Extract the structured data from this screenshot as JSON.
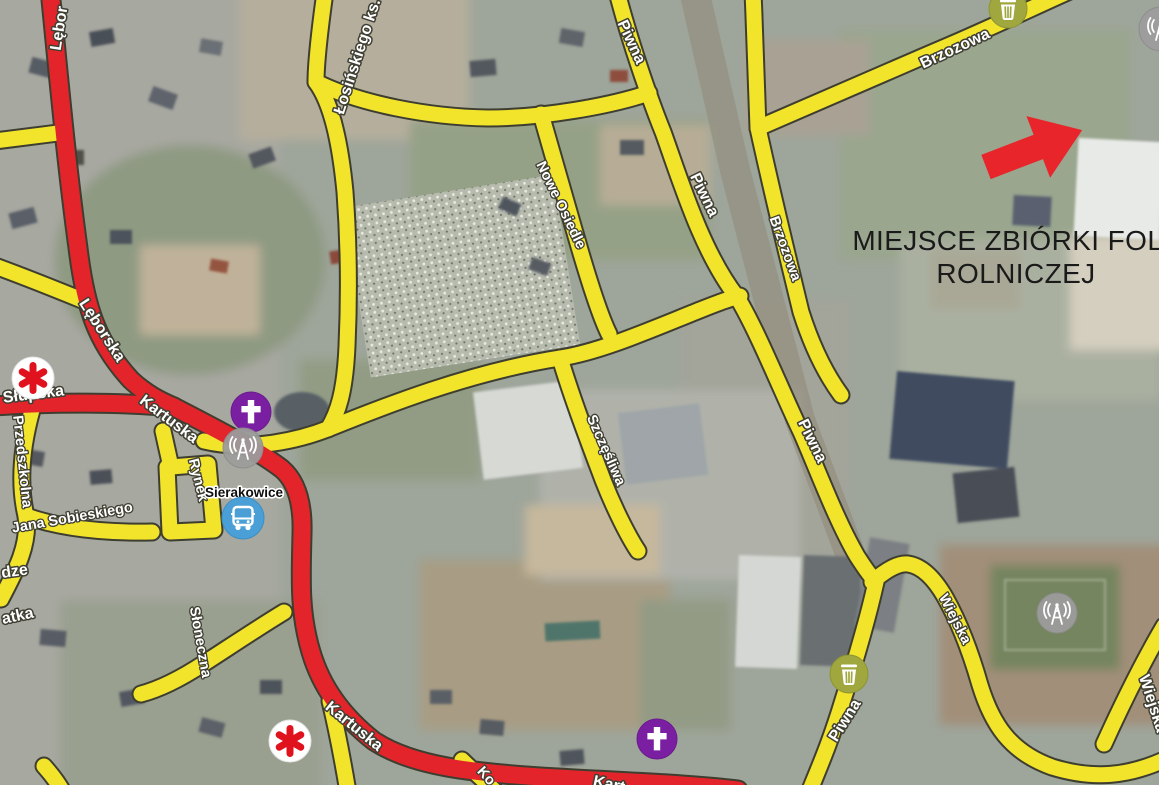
{
  "annotation": {
    "line1": "MIEJSCE ZBIÓRKI FOLII",
    "line2": "ROLNICZEJ"
  },
  "place_labels": {
    "town": "Sierakowice"
  },
  "street_labels": {
    "lebor_fragment": "Lębor",
    "losinskiego": "Łosińskiego ks.",
    "piwna_top": "Piwna",
    "piwna_mid": "Piwna",
    "piwna_right": "Piwna",
    "piwna_bottom": "Piwna",
    "nowe_osiedle": "Nowe Osiedle",
    "brzozowa_top": "Brzozowa",
    "brzozowa_side": "Brzozowa",
    "szczesliwa": "Szczęśliwa",
    "slupska": "Słupska",
    "leborska": "Lęborska",
    "kartuska_1": "Kartuska",
    "kartuska_2": "Kartuska",
    "kart_fragment": "Kart",
    "przedszkolna": "Przedszkolna",
    "jana_sobieskiego": "Jana Sobieskiego",
    "rynek": "Rynek",
    "dze_fragment": "dze",
    "atka_fragment": "atka",
    "sloneczna": "Słoneczna",
    "ko_fragment": "Ko",
    "wiejska_1": "Wiejska",
    "wiejska_2": "Wiejska"
  },
  "icons": {
    "trash_bin_1": "trash-bin-icon",
    "trash_bin_2": "trash-bin-icon",
    "antenna_1": "radio-antenna-icon",
    "antenna_2": "radio-antenna-icon",
    "antenna_3": "radio-antenna-icon",
    "church_1": "church-cross-icon",
    "church_2": "church-cross-icon",
    "bus_station": "bus-icon",
    "medical_1": "medical-asterisk-icon",
    "medical_2": "medical-asterisk-icon",
    "pointer": "red-arrow"
  },
  "colors": {
    "main_road": "#e3252b",
    "secondary_road": "#f2e32b",
    "road_outline": "#3e3e30",
    "annotation_text": "#1a1a1a",
    "arrow": "#e8252b",
    "church_icon_bg": "#7b1fa2",
    "bus_icon_bg": "#4aa0d6",
    "trash_icon_bg": "#a0a73e",
    "antenna_icon_bg": "#9c9c9c",
    "medical_star": "#e0121e",
    "street_label_text": "#ffffff",
    "town_label_text": "#111111"
  }
}
